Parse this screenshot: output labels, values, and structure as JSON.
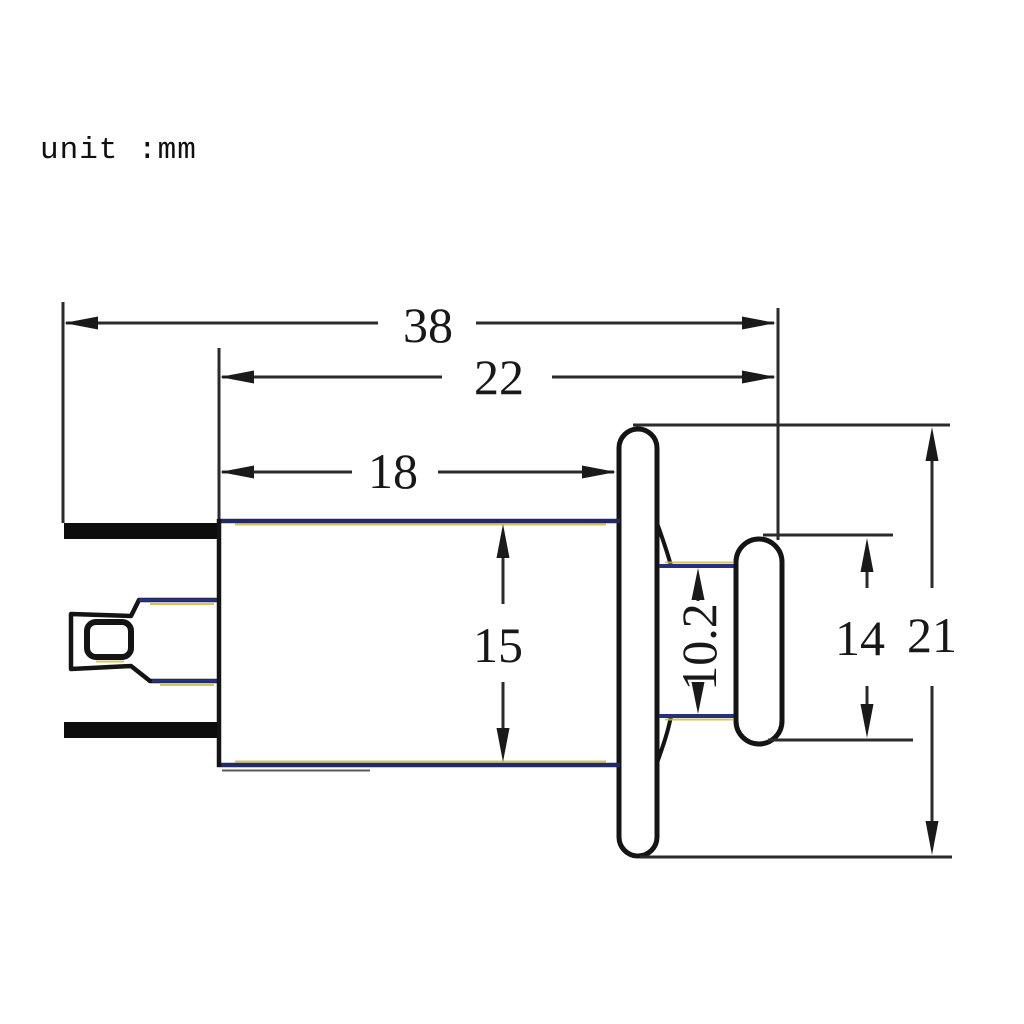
{
  "unit_note": "unit :mm",
  "drawing": {
    "description": "Side-view engineering dimension drawing of a panel-mount socket with flange, push cap and rear spade terminals",
    "unit": "mm",
    "dimensions": {
      "total_length": "38",
      "body_to_cap_length": "22",
      "body_length": "18",
      "body_diameter": "15",
      "neck_diameter": "10.2",
      "cap_diameter": "14",
      "flange_diameter": "21"
    },
    "colors": {
      "outline": "#141414",
      "blue_line": "#27317a",
      "yellow_fringe": "#cdbc3d",
      "background": "#ffffff"
    }
  }
}
